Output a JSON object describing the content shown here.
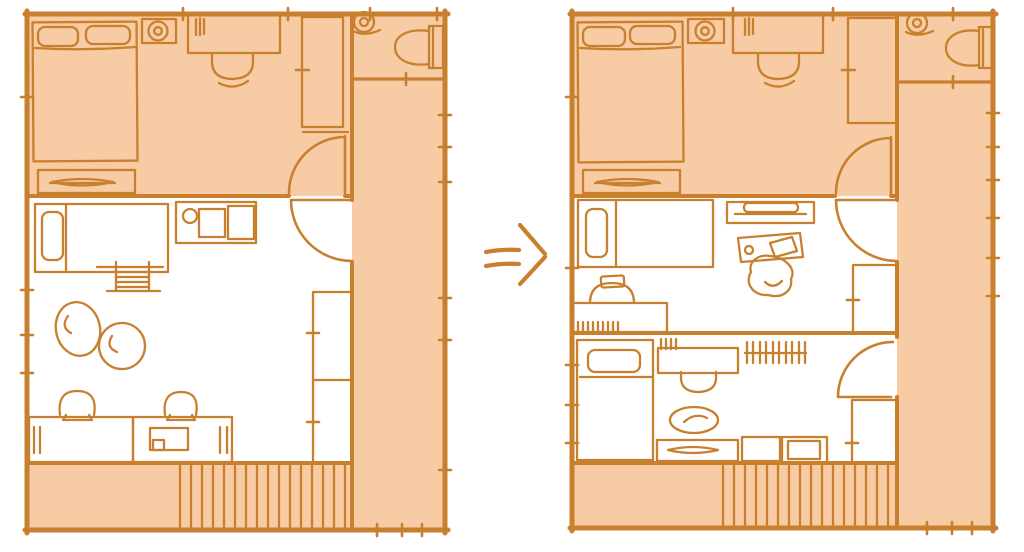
{
  "theme": {
    "line": "#c9802e",
    "fill": "#f7cba3",
    "background": "#ffffff"
  },
  "diagram": {
    "kind": "hand-drawn-floor-plan-before-after",
    "arrow": {
      "icon": "double-right-arrow",
      "glyph": "⇒"
    },
    "before_plan": {
      "rooms": [
        "main-bedroom",
        "shared-kids-room",
        "toilet",
        "side-corridor",
        "veranda-deck"
      ],
      "bedroom_items": [
        "double-bed",
        "pillow",
        "pillow",
        "dresser",
        "round-device",
        "desk",
        "desk-chair",
        "wardrobe",
        "door"
      ],
      "kids_room_items": [
        "single-bed",
        "counter-with-basin",
        "drying-rack",
        "floor-cushion",
        "floor-cushion",
        "low-desk",
        "low-desk-with-drawer",
        "stool",
        "stool",
        "closet",
        "door"
      ],
      "toilet_items": [
        "toilet",
        "round-device"
      ]
    },
    "after_plan": {
      "rooms": [
        "main-bedroom",
        "kids-room-a",
        "kids-room-b",
        "toilet",
        "side-corridor",
        "veranda-deck"
      ],
      "bedroom_items": [
        "double-bed",
        "pillow",
        "pillow",
        "dresser",
        "round-device",
        "desk",
        "desk-chair",
        "wardrobe",
        "door"
      ],
      "kids_room_a_items": [
        "single-bed",
        "wall-shelf",
        "small-desk",
        "beanbag-chair",
        "study-desk",
        "chair",
        "closet",
        "door"
      ],
      "kids_room_b_items": [
        "single-bed",
        "study-desk",
        "chair",
        "floor-cushion",
        "low-cabinet",
        "cabinet",
        "cabinet-with-inner-shelf",
        "towel-rack",
        "closet",
        "door"
      ],
      "toilet_items": [
        "toilet",
        "round-device"
      ]
    }
  }
}
